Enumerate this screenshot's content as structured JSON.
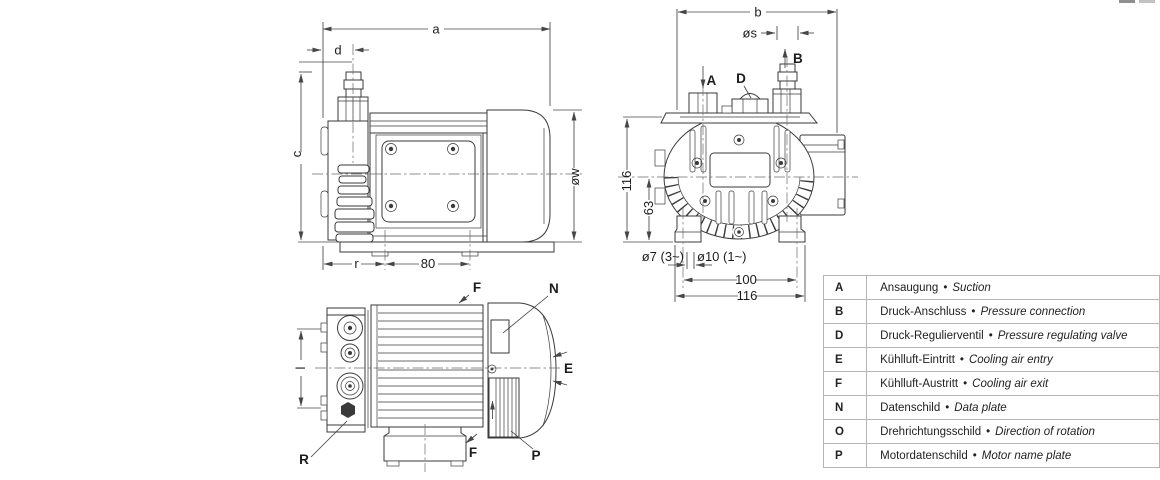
{
  "drawing": {
    "line_color": "#3a3a3a",
    "dim_color": "#464646",
    "center_line_color": "#6b6b6b",
    "side_view": {
      "a": "a",
      "d": "d",
      "c": "c",
      "ow": "øw",
      "r": "r",
      "n80": "80"
    },
    "front_view": {
      "b": "b",
      "os": "øs",
      "v116": "116",
      "v63": "63",
      "o7": "ø7 (3~)",
      "o10": "ø10 (1~)",
      "h100": "100",
      "h116": "116",
      "A": "A",
      "D": "D",
      "B": "B"
    },
    "top_view": {
      "l": "l",
      "F_top": "F",
      "N": "N",
      "E": "E",
      "F_bottom": "F",
      "P": "P",
      "R": "R"
    }
  },
  "legend": {
    "bullet": "•",
    "rows": [
      {
        "key": "A",
        "de": "Ansaugung",
        "en": "Suction"
      },
      {
        "key": "B",
        "de": "Druck-Anschluss",
        "en": "Pressure connection"
      },
      {
        "key": "D",
        "de": "Druck-Regulierventil",
        "en": "Pressure regulating valve"
      },
      {
        "key": "E",
        "de": "Kühlluft-Eintritt",
        "en": "Cooling air entry"
      },
      {
        "key": "F",
        "de": "Kühlluft-Austritt",
        "en": "Cooling air exit"
      },
      {
        "key": "N",
        "de": "Datenschild",
        "en": "Data plate"
      },
      {
        "key": "O",
        "de": "Drehrichtungsschild",
        "en": "Direction of rotation"
      },
      {
        "key": "P",
        "de": "Motordatenschild",
        "en": "Motor name plate"
      }
    ]
  }
}
